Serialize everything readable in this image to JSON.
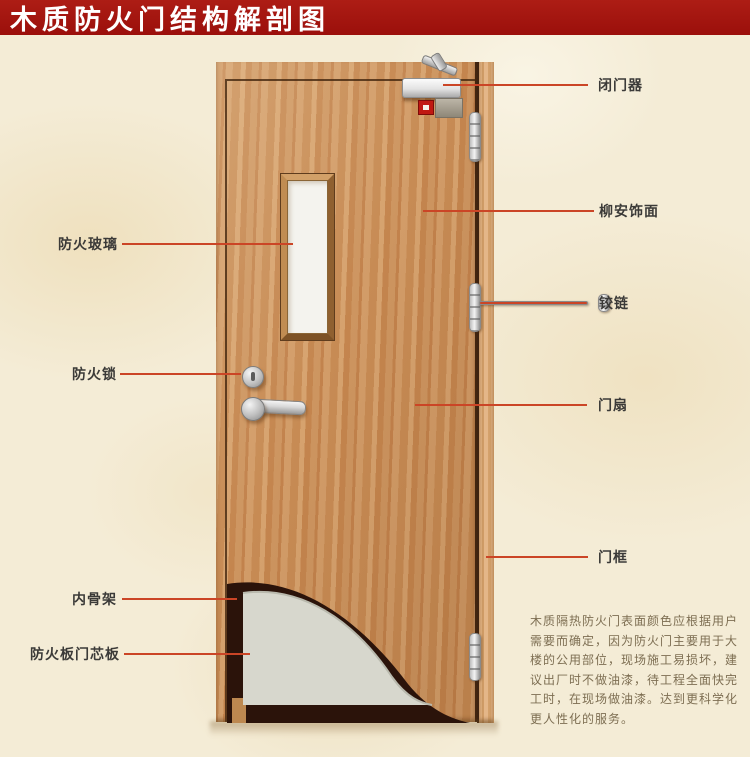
{
  "title": "木质防火门结构解剖图",
  "colors": {
    "banner": "#9b0f0b",
    "callout_line": "#cb4526",
    "background": "#f4ecd6",
    "door_wood": "#c98f5a"
  },
  "labels": {
    "left": [
      {
        "id": "fire-glass",
        "text": "防火玻璃"
      },
      {
        "id": "fire-lock",
        "text": "防火锁"
      },
      {
        "id": "inner-skeleton",
        "text": "内骨架"
      },
      {
        "id": "fire-board-core",
        "text": "防火板门芯板"
      }
    ],
    "right": [
      {
        "id": "door-closer",
        "text": "闭门器"
      },
      {
        "id": "lauan-veneer",
        "text": "柳安饰面"
      },
      {
        "id": "hinge",
        "text": "铰链"
      },
      {
        "id": "door-leaf",
        "text": "门扇"
      },
      {
        "id": "door-frame",
        "text": "门框"
      }
    ]
  },
  "description": {
    "lines": [
      "木质隔热防火门表面颜色应根据用户",
      "需要而确定，因为防火门主要用于大",
      "楼的公用部位，现场施工易损坏，建",
      "议出厂时不做油漆，待工程全面快完",
      "工时，在现场做油漆。达到更科学化",
      "更人性化的服务。"
    ]
  }
}
